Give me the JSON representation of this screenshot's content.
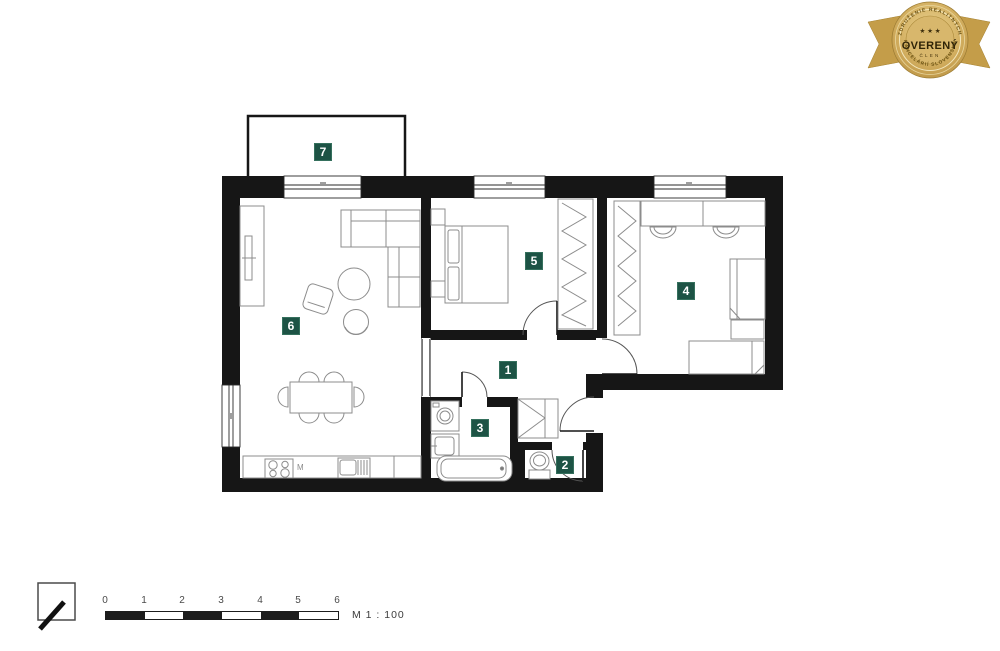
{
  "membership_badge": {
    "top_arc_text": "ZDRUŽENIE REALITNÝCH",
    "bottom_arc_text": "KANCELÁRIÍ SLOVENSKA",
    "stars": "★ ★ ★",
    "title": "OVERENÝ",
    "subtitle": "ČLEN",
    "gold_color": "#cda858",
    "text_color": "#332508"
  },
  "floor_plan": {
    "rooms": [
      {
        "number": "1"
      },
      {
        "number": "2"
      },
      {
        "number": "3"
      },
      {
        "number": "4"
      },
      {
        "number": "5"
      },
      {
        "number": "6"
      },
      {
        "number": "7"
      }
    ],
    "label_bg_color": "#1d5345",
    "kitchen_label": "M"
  },
  "scale_bar": {
    "ticks": [
      "0",
      "1",
      "2",
      "3",
      "4",
      "5",
      "6"
    ],
    "label": "M 1 : 100"
  }
}
